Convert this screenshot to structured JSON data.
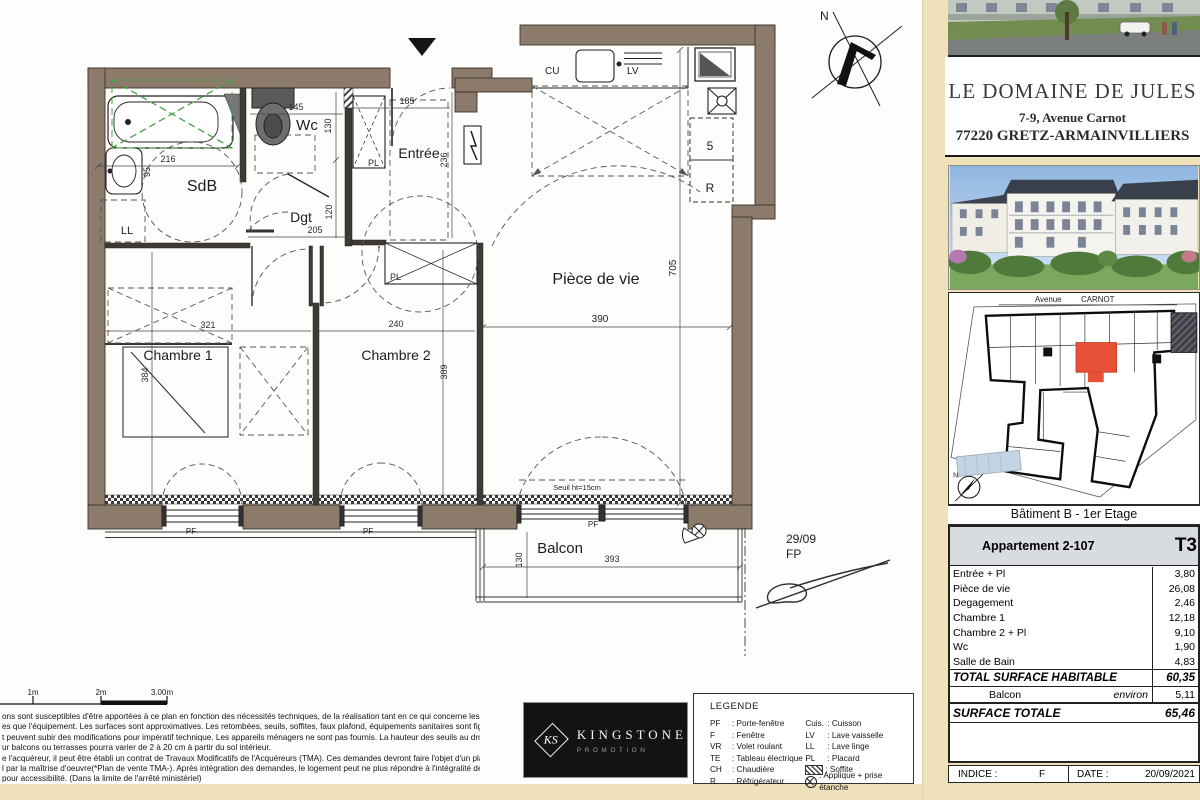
{
  "plan": {
    "labels": {
      "sdb": "SdB",
      "ll": "LL",
      "wc": "Wc",
      "dgt": "Dgt",
      "entree": "Entrée",
      "pl": "PL",
      "cu": "CU",
      "lv": "LV",
      "five": "5",
      "r": "R",
      "piece": "Pièce de vie",
      "ch1": "Chambre 1",
      "ch2": "Chambre 2",
      "balcon": "Balcon",
      "pf": "PF",
      "seuil": "Seuil ht=15cm",
      "note1": "29/09",
      "note2": "FP",
      "north": "N"
    },
    "dims": {
      "w216": "216",
      "h95": "95",
      "w145": "145",
      "h130": "130",
      "w185": "185",
      "h236": "236",
      "w205": "205",
      "h120": "120",
      "w321": "321",
      "h384": "384",
      "w240": "240",
      "h389": "389",
      "w390": "390",
      "h705": "705",
      "w393": "393",
      "h130b": "130"
    }
  },
  "scalebar": {
    "labels": [
      "1m",
      "2m",
      "3.00m"
    ]
  },
  "disclaimer": {
    "lines": [
      "ons sont susceptibles d'être apportées à ce plan en fonction des nécessités techniques, de la réalisation tant en ce qui concerne les",
      "es que l'équipement. Les surfaces sont approximatives. Les retombées, seuils, soffites, faux plafond, équipements sanitaires sont figurés à",
      "t peuvent subir des modifications pour impératif technique. Les appareils ménagers ne sont pas fournis. La hauteur des seuils au droit des",
      "ur balcons ou terrasses pourra varier de 2 à 20 cm à partir du sol intérieur.",
      "e l'acquéreur, il peut être établi un contrat de Travaux Modificatifs de l'Acquéreurs (TMA). Ces demandes devront faire l'objet d'un plan",
      "l par la maîtrise d'oeuvre(*Plan de vente TMA-). Après intégration des demandes, le logement peut ne plus répondre à l'intégralité de la",
      "pour accessibilité. (Dans la limite de l'arrêté ministériel)"
    ]
  },
  "logo": {
    "monogram": "KS",
    "name": "KINGSTONE",
    "subtitle": "PROMOTION"
  },
  "legend": {
    "title": "LEGENDE",
    "left": [
      {
        "k": "PF",
        "v": ": Porte-fenêtre"
      },
      {
        "k": "F",
        "v": ": Fenêtre"
      },
      {
        "k": "VR",
        "v": ": Volet roulant"
      },
      {
        "k": "TE",
        "v": ": Tableau électrique"
      },
      {
        "k": "CH",
        "v": ": Chaudière"
      },
      {
        "k": "R",
        "v": ": Réfrigérateur"
      }
    ],
    "right": [
      {
        "k": "Cuis.",
        "v": ": Cuisson"
      },
      {
        "k": "LV",
        "v": ": Lave vaisselle"
      },
      {
        "k": "LL",
        "v": ": Lave linge"
      },
      {
        "k": "PL",
        "v": ": Placard"
      }
    ],
    "soffite_label": ": Soffite",
    "applique_label": ": Applique + prise étanche"
  },
  "panel": {
    "title": "LE DOMAINE DE JULES",
    "address1": "7-9, Avenue Carnot",
    "address2": "77220 GRETZ-ARMAINVILLIERS",
    "site": {
      "street1": "Avenue",
      "street2": "CARNOT",
      "north": "N"
    },
    "floor_label": "Bâtiment B  -  1er Etage",
    "table": {
      "apartment": "Appartement 2-107",
      "type": "T3",
      "rows": [
        {
          "label": "Entrée + Pl",
          "value": "3,80"
        },
        {
          "label": "Pièce de vie",
          "value": "26,08"
        },
        {
          "label": "Degagement",
          "value": "2,46"
        },
        {
          "label": "Chambre 1",
          "value": "12,18"
        },
        {
          "label": "Chambre 2 + Pl",
          "value": "9,10"
        },
        {
          "label": "Wc",
          "value": "1,90"
        },
        {
          "label": "Salle de Bain",
          "value": "4,83"
        }
      ],
      "total": {
        "label": "TOTAL SURFACE HABITABLE",
        "value": "60,35"
      },
      "balcon": {
        "label": "Balcon",
        "qualifier": "environ",
        "value": "5,11"
      },
      "surface": {
        "label": "SURFACE TOTALE",
        "value": "65,46"
      },
      "footer": {
        "indice_label": "INDICE :",
        "indice_value": "F",
        "date_label": "DATE :",
        "date_value": "20/09/2021"
      }
    }
  }
}
